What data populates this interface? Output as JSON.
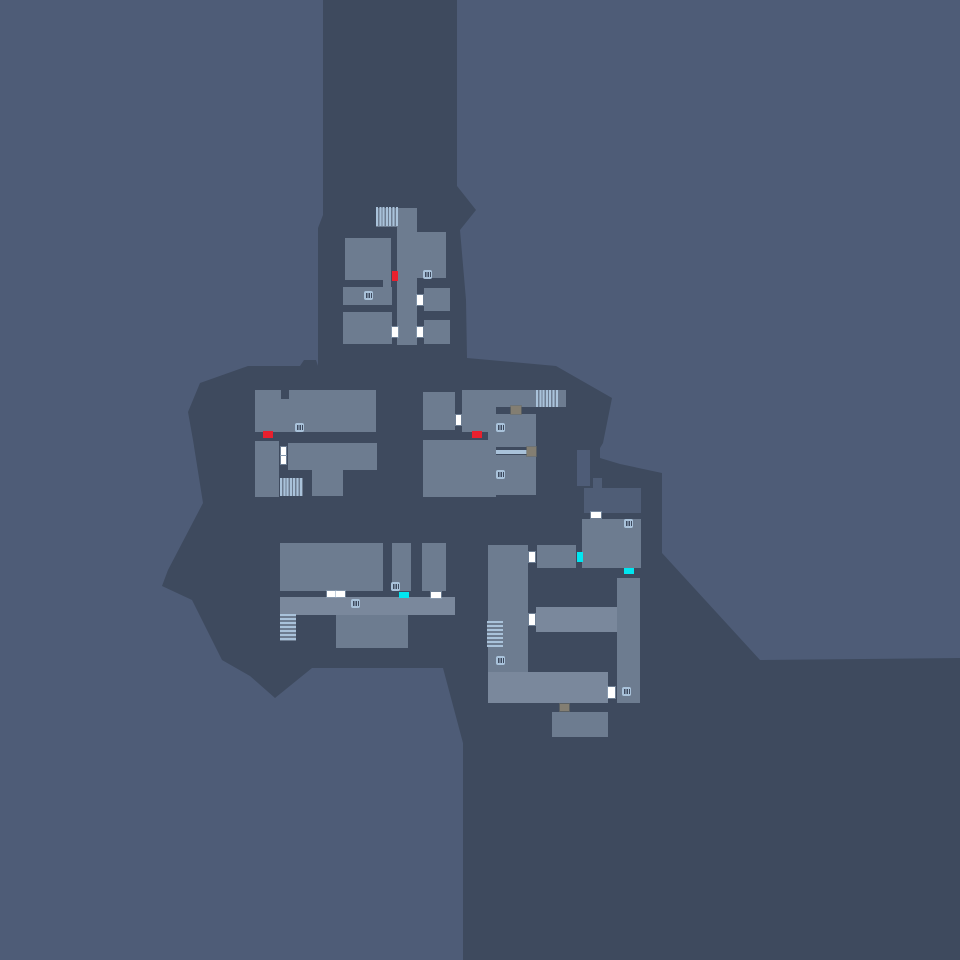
{
  "map": {
    "width": 960,
    "height": 960,
    "colors": {
      "background": "#4E5C77",
      "terrain": "#3E4A5E",
      "room": "#6D7C90",
      "hall": "#7A889C",
      "shaft_room": "#4F5D76",
      "icon_blue": "#A9C2DA",
      "door_white": "#FFFFFF",
      "door_red": "#E8202E",
      "door_cyan": "#00E6F0",
      "door_gray": "#837E72"
    },
    "terrain_polygon": [
      [
        323,
        0
      ],
      [
        457,
        0
      ],
      [
        457,
        186
      ],
      [
        476,
        210
      ],
      [
        460,
        230
      ],
      [
        466,
        300
      ],
      [
        467,
        358
      ],
      [
        556,
        366
      ],
      [
        612,
        398
      ],
      [
        603,
        443
      ],
      [
        600,
        448
      ],
      [
        600,
        458
      ],
      [
        620,
        464
      ],
      [
        662,
        473
      ],
      [
        662,
        553
      ],
      [
        760,
        660
      ],
      [
        960,
        658
      ],
      [
        960,
        960
      ],
      [
        463,
        960
      ],
      [
        463,
        743
      ],
      [
        443,
        668
      ],
      [
        312,
        668
      ],
      [
        275,
        698
      ],
      [
        250,
        676
      ],
      [
        222,
        660
      ],
      [
        192,
        600
      ],
      [
        162,
        586
      ],
      [
        168,
        570
      ],
      [
        203,
        503
      ],
      [
        193,
        440
      ],
      [
        188,
        412
      ],
      [
        200,
        383
      ],
      [
        248,
        366
      ],
      [
        300,
        366
      ],
      [
        304,
        360
      ],
      [
        316,
        360
      ],
      [
        318,
        366
      ],
      [
        318,
        228
      ],
      [
        323,
        215
      ]
    ],
    "rooms": [
      {
        "id": "top-ladder-base",
        "kind": "room",
        "x": 376,
        "y": 208,
        "w": 22,
        "h": 19
      },
      {
        "id": "top-corridor",
        "kind": "room",
        "x": 397,
        "y": 208,
        "w": 20,
        "h": 137
      },
      {
        "id": "top-room-nw",
        "kind": "room",
        "x": 345,
        "y": 238,
        "w": 46,
        "h": 42
      },
      {
        "id": "top-room-nw-ext",
        "kind": "room",
        "x": 383,
        "y": 278,
        "w": 8,
        "h": 10
      },
      {
        "id": "top-room-ne",
        "kind": "room",
        "x": 415,
        "y": 232,
        "w": 31,
        "h": 46
      },
      {
        "id": "top-room-w",
        "kind": "room",
        "x": 343,
        "y": 287,
        "w": 49,
        "h": 18
      },
      {
        "id": "top-room-e",
        "kind": "room",
        "x": 424,
        "y": 288,
        "w": 26,
        "h": 23
      },
      {
        "id": "top-room-sw",
        "kind": "room",
        "x": 343,
        "y": 312,
        "w": 49,
        "h": 32
      },
      {
        "id": "top-room-se",
        "kind": "room",
        "x": 424,
        "y": 320,
        "w": 26,
        "h": 24
      },
      {
        "id": "midleft-top",
        "kind": "room",
        "x": 255,
        "y": 390,
        "w": 121,
        "h": 42
      },
      {
        "id": "midleft-west",
        "kind": "room",
        "x": 255,
        "y": 441,
        "w": 24,
        "h": 56
      },
      {
        "id": "midleft-big",
        "kind": "room",
        "x": 288,
        "y": 443,
        "w": 89,
        "h": 27
      },
      {
        "id": "midleft-ext",
        "kind": "room",
        "x": 312,
        "y": 470,
        "w": 31,
        "h": 26
      },
      {
        "id": "midleft-ladder-base",
        "kind": "room",
        "x": 280,
        "y": 478,
        "w": 23,
        "h": 18
      },
      {
        "id": "midright-small",
        "kind": "room",
        "x": 423,
        "y": 392,
        "w": 32,
        "h": 38
      },
      {
        "id": "midright-hall",
        "kind": "room",
        "x": 462,
        "y": 390,
        "w": 104,
        "h": 17
      },
      {
        "id": "midright-hall-leg",
        "kind": "room",
        "x": 462,
        "y": 407,
        "w": 26,
        "h": 25
      },
      {
        "id": "midright-strip",
        "kind": "room",
        "x": 488,
        "y": 407,
        "w": 8,
        "h": 90
      },
      {
        "id": "midright-big",
        "kind": "room",
        "x": 423,
        "y": 440,
        "w": 65,
        "h": 57
      },
      {
        "id": "midright-upper",
        "kind": "room",
        "x": 496,
        "y": 414,
        "w": 40,
        "h": 33
      },
      {
        "id": "midright-lower",
        "kind": "room",
        "x": 496,
        "y": 455,
        "w": 40,
        "h": 40
      },
      {
        "id": "botleft-big",
        "kind": "room",
        "x": 280,
        "y": 543,
        "w": 103,
        "h": 48
      },
      {
        "id": "botleft-thin",
        "kind": "room",
        "x": 392,
        "y": 543,
        "w": 19,
        "h": 48
      },
      {
        "id": "botleft-east",
        "kind": "room",
        "x": 422,
        "y": 543,
        "w": 24,
        "h": 48
      },
      {
        "id": "botleft-hall",
        "kind": "hall",
        "x": 280,
        "y": 597,
        "w": 175,
        "h": 18
      },
      {
        "id": "botleft-south",
        "kind": "room",
        "x": 336,
        "y": 615,
        "w": 72,
        "h": 33
      },
      {
        "id": "botleft-stairs-base",
        "kind": "room",
        "x": 280,
        "y": 614,
        "w": 16,
        "h": 27
      },
      {
        "id": "botright-shaft-stub",
        "kind": "shaft",
        "x": 593,
        "y": 478,
        "w": 9,
        "h": 10
      },
      {
        "id": "botright-shaft-room",
        "kind": "shaft",
        "x": 584,
        "y": 488,
        "w": 57,
        "h": 25
      },
      {
        "id": "botright-east-room",
        "kind": "room",
        "x": 582,
        "y": 519,
        "w": 59,
        "h": 49
      },
      {
        "id": "botright-mid-room",
        "kind": "room",
        "x": 537,
        "y": 545,
        "w": 39,
        "h": 23
      },
      {
        "id": "botright-tall-room",
        "kind": "room",
        "x": 488,
        "y": 545,
        "w": 40,
        "h": 158
      },
      {
        "id": "botright-hall",
        "kind": "hall",
        "x": 536,
        "y": 607,
        "w": 81,
        "h": 25
      },
      {
        "id": "botright-bottom-hall",
        "kind": "hall",
        "x": 488,
        "y": 672,
        "w": 120,
        "h": 31
      },
      {
        "id": "botright-tall-east",
        "kind": "room",
        "x": 617,
        "y": 578,
        "w": 23,
        "h": 125
      },
      {
        "id": "botright-south-room",
        "kind": "room",
        "x": 552,
        "y": 712,
        "w": 56,
        "h": 25
      },
      {
        "id": "botright-stairs-base",
        "kind": "room",
        "x": 487,
        "y": 621,
        "w": 16,
        "h": 26
      }
    ],
    "patches": [
      {
        "kind": "dark",
        "x": 281,
        "y": 390,
        "w": 8,
        "h": 9
      },
      {
        "kind": "bg",
        "x": 577,
        "y": 450,
        "w": 13,
        "h": 36
      }
    ],
    "dividers": [
      {
        "id": "window-ledge-dark",
        "color": "#3E4A5E",
        "x": 496,
        "y": 447,
        "w": 40,
        "h": 3
      },
      {
        "id": "window-ledge-blue",
        "color": "#A9C2DA",
        "x": 496,
        "y": 450,
        "w": 33,
        "h": 4
      }
    ],
    "doors": [
      {
        "type": "white",
        "x": 417,
        "y": 295,
        "w": 6,
        "h": 10
      },
      {
        "type": "white",
        "x": 417,
        "y": 327,
        "w": 6,
        "h": 10
      },
      {
        "type": "white",
        "x": 392,
        "y": 327,
        "w": 6,
        "h": 10
      },
      {
        "type": "white",
        "x": 456,
        "y": 415,
        "w": 5,
        "h": 10
      },
      {
        "type": "white",
        "x": 281,
        "y": 447,
        "w": 5,
        "h": 8
      },
      {
        "type": "white",
        "x": 281,
        "y": 456,
        "w": 5,
        "h": 8
      },
      {
        "type": "white",
        "x": 327,
        "y": 591,
        "w": 9,
        "h": 6
      },
      {
        "type": "white",
        "x": 336,
        "y": 591,
        "w": 9,
        "h": 6
      },
      {
        "type": "white",
        "x": 431,
        "y": 592,
        "w": 10,
        "h": 6
      },
      {
        "type": "white",
        "x": 591,
        "y": 512,
        "w": 10,
        "h": 6
      },
      {
        "type": "white",
        "x": 529,
        "y": 552,
        "w": 6,
        "h": 10
      },
      {
        "type": "white",
        "x": 529,
        "y": 614,
        "w": 6,
        "h": 11
      },
      {
        "type": "white",
        "x": 608,
        "y": 687,
        "w": 7,
        "h": 11
      },
      {
        "type": "red",
        "x": 392,
        "y": 271,
        "w": 6,
        "h": 10
      },
      {
        "type": "red",
        "x": 263,
        "y": 431,
        "w": 10,
        "h": 7
      },
      {
        "type": "red",
        "x": 472,
        "y": 431,
        "w": 10,
        "h": 7
      },
      {
        "type": "cyan",
        "x": 399,
        "y": 592,
        "w": 10,
        "h": 6
      },
      {
        "type": "cyan",
        "x": 624,
        "y": 568,
        "w": 10,
        "h": 6
      },
      {
        "type": "cyan",
        "x": 577,
        "y": 552,
        "w": 6,
        "h": 10
      },
      {
        "type": "gray",
        "x": 511,
        "y": 406,
        "w": 10,
        "h": 8
      },
      {
        "type": "gray",
        "x": 527,
        "y": 447,
        "w": 9,
        "h": 9
      },
      {
        "type": "gray",
        "x": 560,
        "y": 704,
        "w": 9,
        "h": 7
      }
    ],
    "icons": [
      {
        "type": "vent",
        "x": 423,
        "y": 270,
        "w": 9,
        "h": 9
      },
      {
        "type": "vent",
        "x": 364,
        "y": 291,
        "w": 9,
        "h": 9
      },
      {
        "type": "vent",
        "x": 295,
        "y": 423,
        "w": 9,
        "h": 9
      },
      {
        "type": "vent",
        "x": 496,
        "y": 423,
        "w": 9,
        "h": 9
      },
      {
        "type": "vent",
        "x": 496,
        "y": 470,
        "w": 9,
        "h": 9
      },
      {
        "type": "vent",
        "x": 351,
        "y": 599,
        "w": 9,
        "h": 9
      },
      {
        "type": "vent",
        "x": 391,
        "y": 582,
        "w": 9,
        "h": 9
      },
      {
        "type": "vent",
        "x": 624,
        "y": 519,
        "w": 9,
        "h": 9
      },
      {
        "type": "vent",
        "x": 496,
        "y": 656,
        "w": 9,
        "h": 9
      },
      {
        "type": "vent",
        "x": 622,
        "y": 687,
        "w": 9,
        "h": 9
      },
      {
        "type": "ladder",
        "x": 376,
        "y": 207,
        "w": 22,
        "h": 19
      },
      {
        "type": "ladder",
        "x": 536,
        "y": 390,
        "w": 22,
        "h": 17
      },
      {
        "type": "ladder",
        "x": 280,
        "y": 478,
        "w": 23,
        "h": 18
      },
      {
        "type": "stairs",
        "x": 280,
        "y": 614,
        "w": 16,
        "h": 27
      },
      {
        "type": "stairs",
        "x": 487,
        "y": 621,
        "w": 16,
        "h": 26
      }
    ]
  }
}
